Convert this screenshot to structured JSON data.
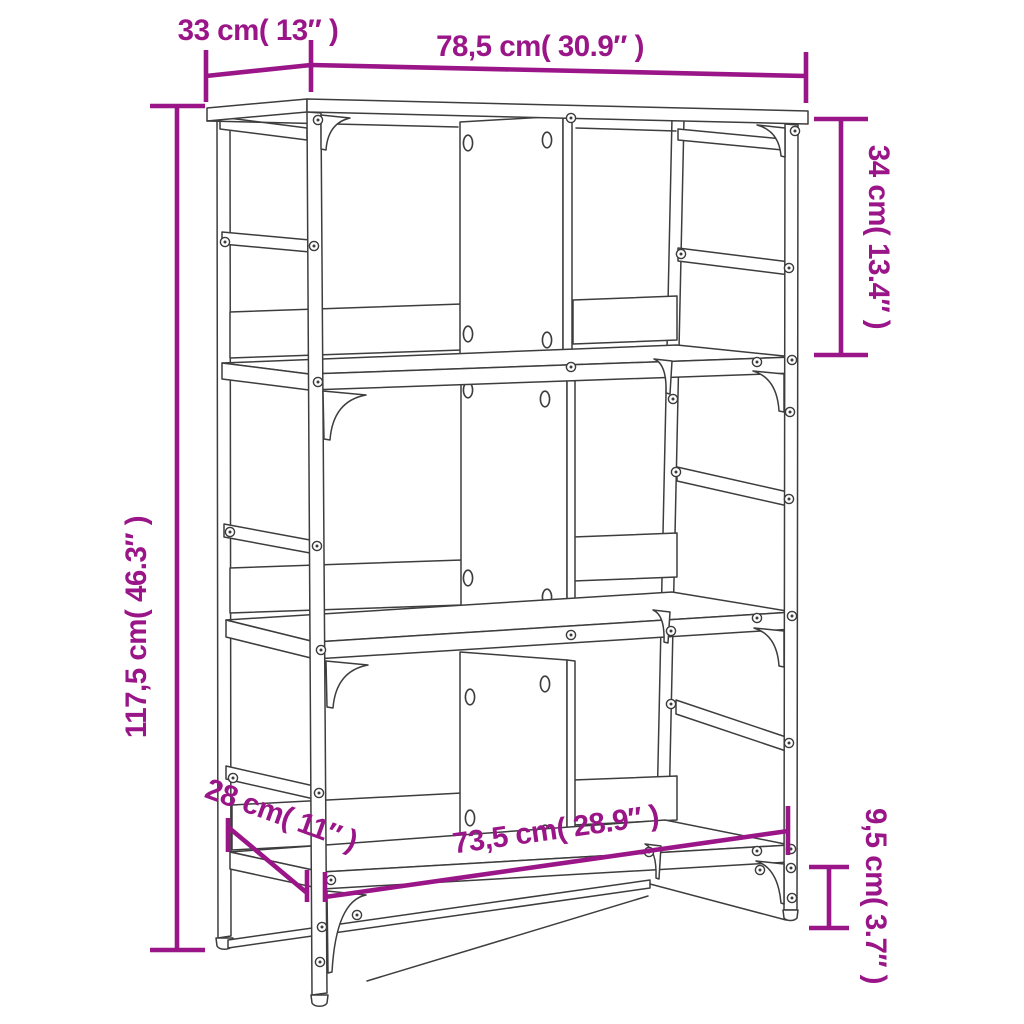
{
  "diagram": {
    "kind": "furniture-dimension-diagram",
    "product": "three-tier-bookshelf-line-drawing",
    "colors": {
      "dimension": "#9A1688",
      "drawing": "#3d3d3d",
      "background": "#ffffff"
    },
    "dimensions": {
      "top_depth": "33 cm( 13″ )",
      "top_width": "78,5 cm( 30.9″ )",
      "tier_height": "34 cm( 13.4″ )",
      "total_height": "117,5 cm( 46.3″ )",
      "bottom_depth": "28 cm( 11″ )",
      "bottom_width": "73,5 cm( 28.9″ )",
      "ground_clearance": "9,5 cm( 3.7″ )"
    }
  }
}
